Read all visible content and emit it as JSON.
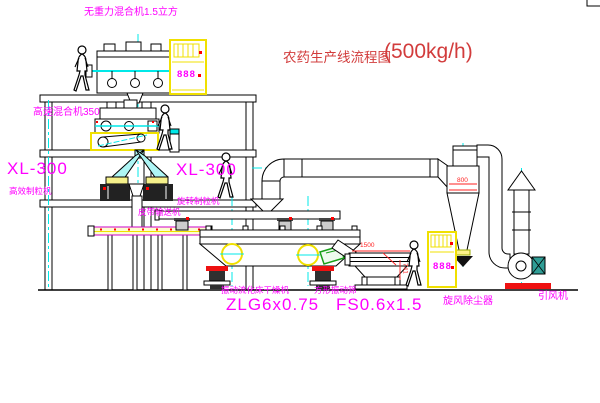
{
  "title": {
    "name": "农药生产线流程图",
    "capacity": "(500kg/h)"
  },
  "labels": {
    "gravity_mixer": "无重力混合机1.5立方",
    "high_speed_mixer": "高速混合机350",
    "granulator_left_model": "XL-300",
    "granulator_left_name": "高效制粒机",
    "granulator_right_model": "XL-300",
    "granulator_right_name": "旋转制粒机",
    "belt_conveyor": "皮带输送机",
    "dryer_name": "振动流化床干燥机",
    "dryer_model": "ZLG6x0.75",
    "screen_name": "方形振动筛",
    "screen_model": "FS0.6x1.5",
    "cyclone": "旋风除尘器",
    "fan": "引风机"
  },
  "dimensions": {
    "cyclone_width": "800",
    "screen_length": "1500",
    "screen_height": "741"
  },
  "cabinets": {
    "upper_display": "888",
    "lower_display": "888"
  },
  "colors": {
    "label": "#ff00ff",
    "title": "#d23c3c",
    "dimension": "#ff2222",
    "centerline": "#00e8e8",
    "highlight": "#f0e000"
  }
}
